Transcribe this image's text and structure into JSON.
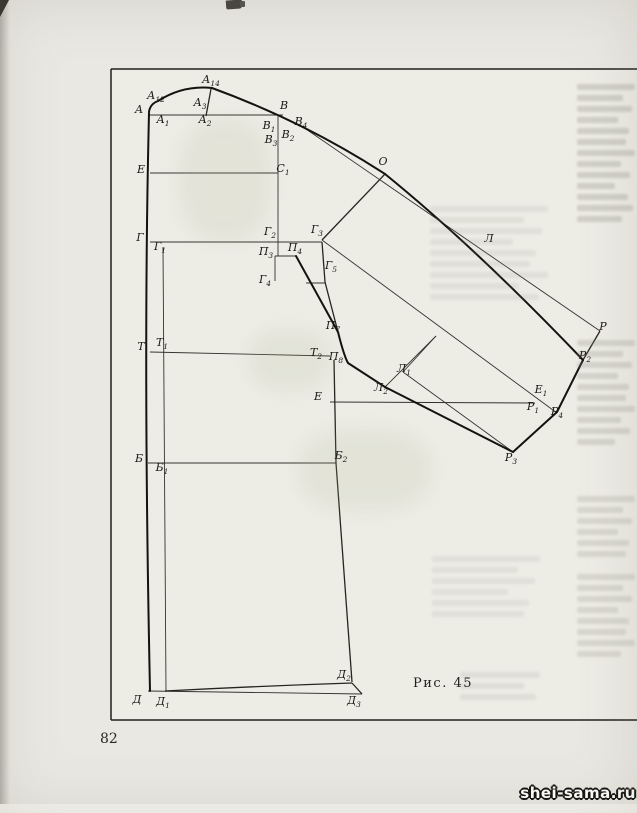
{
  "page": {
    "number": "82",
    "caption": "Рис. 45",
    "watermark": "shei-sama.ru"
  },
  "colors": {
    "paper": "#e9e8e2",
    "figure_paper": "#edece5",
    "ink": "#15130f",
    "watermark_fill": "#ffffff",
    "watermark_outline": "#14120e"
  },
  "diagram": {
    "points": [
      {
        "m": "А",
        "s": "12",
        "x": 156,
        "y": 96
      },
      {
        "m": "А",
        "s": "14",
        "x": 211,
        "y": 80
      },
      {
        "m": "А",
        "s": "",
        "x": 139,
        "y": 110
      },
      {
        "m": "А",
        "s": "1",
        "x": 163,
        "y": 120
      },
      {
        "m": "А",
        "s": "3",
        "x": 200,
        "y": 103
      },
      {
        "m": "А",
        "s": "2",
        "x": 205,
        "y": 120
      },
      {
        "m": "В",
        "s": "",
        "x": 284,
        "y": 106
      },
      {
        "m": "В",
        "s": "1",
        "x": 269,
        "y": 126
      },
      {
        "m": "В",
        "s": "4",
        "x": 301,
        "y": 122
      },
      {
        "m": "В",
        "s": "2",
        "x": 288,
        "y": 135
      },
      {
        "m": "В",
        "s": "3",
        "x": 271,
        "y": 140
      },
      {
        "m": "Е",
        "s": "",
        "x": 141,
        "y": 170
      },
      {
        "m": "С",
        "s": "1",
        "x": 283,
        "y": 169
      },
      {
        "m": "Г",
        "s": "",
        "x": 140,
        "y": 238
      },
      {
        "m": "Г",
        "s": "1",
        "x": 160,
        "y": 247
      },
      {
        "m": "Г",
        "s": "2",
        "x": 270,
        "y": 232
      },
      {
        "m": "Г",
        "s": "3",
        "x": 317,
        "y": 230
      },
      {
        "m": "П",
        "s": "3",
        "x": 266,
        "y": 252
      },
      {
        "m": "П",
        "s": "4",
        "x": 295,
        "y": 248
      },
      {
        "m": "Г",
        "s": "4",
        "x": 265,
        "y": 280
      },
      {
        "m": "Г",
        "s": "5",
        "x": 331,
        "y": 266
      },
      {
        "m": "О",
        "s": "",
        "x": 383,
        "y": 162
      },
      {
        "m": "Л",
        "s": "",
        "x": 489,
        "y": 239
      },
      {
        "m": "П",
        "s": "7",
        "x": 333,
        "y": 326
      },
      {
        "m": "Т",
        "s": "",
        "x": 141,
        "y": 347
      },
      {
        "m": "Т",
        "s": "1",
        "x": 162,
        "y": 343
      },
      {
        "m": "Т",
        "s": "2",
        "x": 316,
        "y": 353
      },
      {
        "m": "П",
        "s": "8",
        "x": 336,
        "y": 357
      },
      {
        "m": "Л",
        "s": "1",
        "x": 404,
        "y": 369
      },
      {
        "m": "Л",
        "s": "2",
        "x": 381,
        "y": 388
      },
      {
        "m": "Е",
        "s": "",
        "x": 318,
        "y": 397
      },
      {
        "m": "Е",
        "s": "1",
        "x": 541,
        "y": 390
      },
      {
        "m": "Р",
        "s": "",
        "x": 603,
        "y": 327
      },
      {
        "m": "Р",
        "s": "2",
        "x": 585,
        "y": 356
      },
      {
        "m": "Р",
        "s": "1",
        "x": 533,
        "y": 407
      },
      {
        "m": "Р",
        "s": "4",
        "x": 557,
        "y": 412
      },
      {
        "m": "Р",
        "s": "3",
        "x": 511,
        "y": 458
      },
      {
        "m": "Б",
        "s": "",
        "x": 139,
        "y": 459
      },
      {
        "m": "Б",
        "s": "1",
        "x": 162,
        "y": 468
      },
      {
        "m": "Б",
        "s": "2",
        "x": 341,
        "y": 456
      },
      {
        "m": "Д",
        "s": "",
        "x": 137,
        "y": 700
      },
      {
        "m": "Д",
        "s": "1",
        "x": 163,
        "y": 702
      },
      {
        "m": "Д",
        "s": "2",
        "x": 344,
        "y": 675
      },
      {
        "m": "Д",
        "s": "3",
        "x": 354,
        "y": 701
      }
    ],
    "lines": [
      {
        "n": "frame-top",
        "c": "frame",
        "d": "M111,69 L637,69"
      },
      {
        "n": "frame-left",
        "c": "frame",
        "d": "M111,69 L111,720"
      },
      {
        "n": "frame-bottom",
        "c": "frame",
        "d": "M111,720 L637,720"
      },
      {
        "n": "line-neck-shoulder-row",
        "c": "thin",
        "d": "M149,115 L283,115"
      },
      {
        "n": "line-chest-row-E-C1",
        "c": "thin",
        "d": "M150,173 L278,173"
      },
      {
        "n": "line-bust-row-G-G3",
        "c": "thin",
        "d": "M150,242 L322,242"
      },
      {
        "n": "line-waist-row-T-T2",
        "c": "thin",
        "d": "M150,352 L330,356"
      },
      {
        "n": "line-hip-row-B-B2",
        "c": "thin",
        "d": "M148,463 L336,463"
      },
      {
        "n": "line-elbow-row-E-P1",
        "c": "thin",
        "d": "M330,402 L535,403"
      },
      {
        "n": "line-hem-baseline",
        "c": "thin",
        "d": "M148,691 L362,694"
      },
      {
        "n": "line-vertical-V3",
        "c": "thin",
        "d": "M278,116 L278,256"
      },
      {
        "n": "line-vertical-G1-D1",
        "c": "thin",
        "d": "M163,247 L166,691"
      },
      {
        "n": "line-G3-down-P7",
        "c": "med",
        "d": "M322,242 L325,282 L338,332"
      },
      {
        "n": "tick-G5",
        "c": "thin",
        "d": "M306,283 L325,283"
      },
      {
        "n": "tick-P3-P4",
        "c": "thin",
        "d": "M275,256 L296,256"
      },
      {
        "n": "tick-P3-G4",
        "c": "thin",
        "d": "M275,256 L275,281"
      },
      {
        "n": "line-O-G3",
        "c": "med",
        "d": "M385,174 L322,240"
      },
      {
        "n": "line-V4-R",
        "c": "thin",
        "d": "M303,127 L600,331"
      },
      {
        "n": "line-G3-E1-P4",
        "c": "thin",
        "d": "M322,240 L557,413"
      },
      {
        "n": "dart-leg-L2",
        "c": "thin",
        "d": "M385,387 L436,336"
      },
      {
        "n": "dart-leg-L1",
        "c": "thin",
        "d": "M403,372 L436,336"
      },
      {
        "n": "seam-L1-P3",
        "c": "thin",
        "d": "M403,372 L513,452"
      },
      {
        "n": "outline-front-edge",
        "c": "heavy",
        "d": "M149,113 Q143,360 150,691"
      },
      {
        "n": "outline-neck-left",
        "c": "heavy",
        "d": "M158,101 Q150,104 149,112"
      },
      {
        "n": "outline-neck-curve",
        "c": "heavy",
        "d": "M158,101 Q183,85 212,88"
      },
      {
        "n": "tick-A14-A2",
        "c": "med",
        "d": "M211,89 L206,116"
      },
      {
        "n": "outline-sleeve-top-1",
        "c": "heavy",
        "d": "M212,88 Q305,122 385,174"
      },
      {
        "n": "outline-sleeve-top-2",
        "c": "heavy",
        "d": "M385,174 Q475,247 583,360"
      },
      {
        "n": "seam-P4-P7",
        "c": "heavy",
        "d": "M296,256 L338,332"
      },
      {
        "n": "seam-P7-P8-L2",
        "c": "heavy",
        "d": "M338,332 Q344,356 348,363 L385,387"
      },
      {
        "n": "seam-L2-P3",
        "c": "heavy",
        "d": "M385,387 L513,452"
      },
      {
        "n": "cuff-R2-R",
        "c": "med",
        "d": "M583,360 L600,331"
      },
      {
        "n": "cuff-R2-R4-R3",
        "c": "heavy",
        "d": "M583,360 L557,412 L513,452"
      },
      {
        "n": "side-seam",
        "c": "med",
        "d": "M334,360 L336,463 L352,682"
      },
      {
        "n": "hem-curve",
        "c": "med",
        "d": "M165,691 Q260,686 352,683"
      },
      {
        "n": "hem-corner",
        "c": "med",
        "d": "M352,683 L362,694"
      }
    ]
  }
}
